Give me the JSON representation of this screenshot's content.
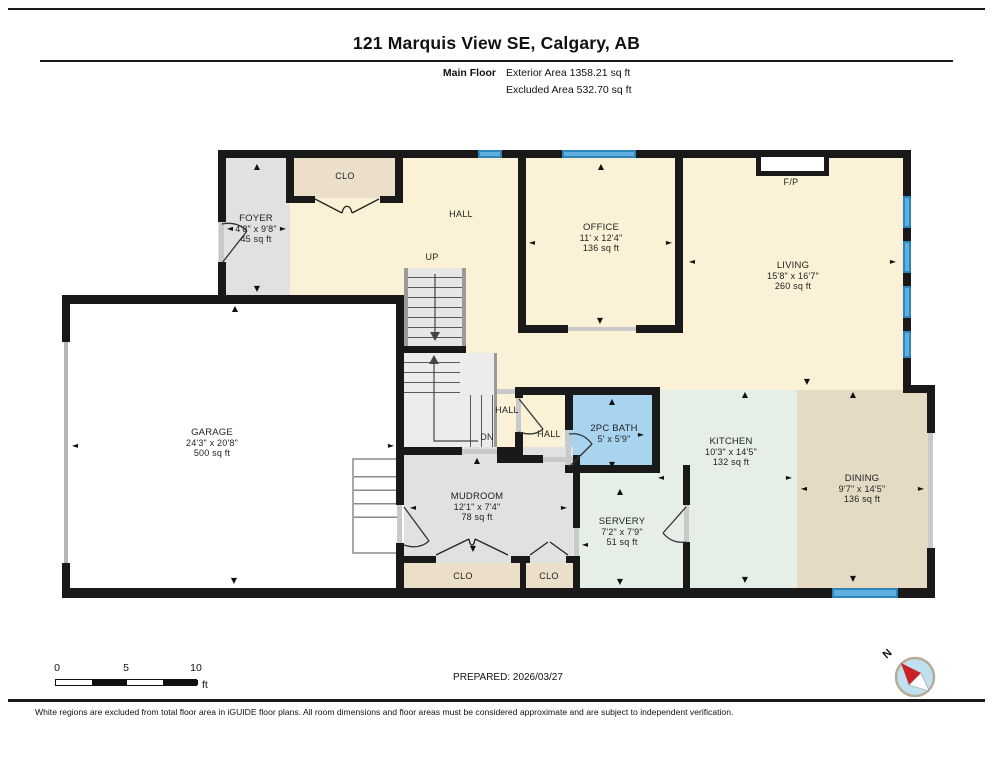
{
  "header": {
    "title": "121 Marquis View SE, Calgary, AB",
    "floor_label": "Main Floor",
    "exterior_area": "Exterior Area 1358.21 sq ft",
    "excluded_area": "Excluded Area 532.70 sq ft"
  },
  "rooms": {
    "foyer": {
      "name": "FOYER",
      "dims": "4'8\" x 9'8\"",
      "area": "45 sq ft"
    },
    "office": {
      "name": "OFFICE",
      "dims": "11' x 12'4\"",
      "area": "136 sq ft"
    },
    "living": {
      "name": "LIVING",
      "dims": "15'8\" x 16'7\"",
      "area": "260 sq ft"
    },
    "garage": {
      "name": "GARAGE",
      "dims": "24'3\" x 20'8\"",
      "area": "500 sq ft"
    },
    "mudroom": {
      "name": "MUDROOM",
      "dims": "12'1\" x 7'4\"",
      "area": "78 sq ft"
    },
    "bath": {
      "name": "2PC BATH",
      "dims": "5' x 5'9\""
    },
    "servery": {
      "name": "SERVERY",
      "dims": "7'2\" x 7'9\"",
      "area": "51 sq ft"
    },
    "kitchen": {
      "name": "KITCHEN",
      "dims": "10'3\" x 14'5\"",
      "area": "132 sq ft"
    },
    "dining": {
      "name": "DINING",
      "dims": "9'7\" x 14'5\"",
      "area": "136 sq ft"
    }
  },
  "labels": {
    "hall": "HALL",
    "up": "UP",
    "dn": "DN",
    "clo": "CLO",
    "fireplace": "F/P",
    "north": "N"
  },
  "footer": {
    "scale_ticks": [
      "0",
      "5",
      "10"
    ],
    "scale_unit": "ft",
    "prepared": "PREPARED: 2026/03/27",
    "disclaimer": "White regions are excluded from total floor area in iGUIDE floor plans. All room dimensions and floor areas must be considered approximate and are subject to independent verification."
  },
  "colors": {
    "cream": "#fbf1d7",
    "floor_gray": "#e1e1e1",
    "closet_tan": "#ecdfca",
    "bath_blue": "#a9d4ef",
    "mint": "#e6efe7",
    "dining_tan": "#e5dbc5",
    "wall": "#191919",
    "window": "#5fb0e0",
    "compass_red": "#cc2027",
    "compass_blue": "#bfe0ef"
  },
  "plan": {
    "arrows": [
      {
        "g": "▲",
        "x": 257,
        "y": 167
      },
      {
        "g": "▼",
        "x": 257,
        "y": 289
      },
      {
        "g": "◄",
        "x": 230,
        "y": 229
      },
      {
        "g": "►",
        "x": 283,
        "y": 229
      },
      {
        "g": "▲",
        "x": 601,
        "y": 167
      },
      {
        "g": "▼",
        "x": 600,
        "y": 321
      },
      {
        "g": "◄",
        "x": 532,
        "y": 243
      },
      {
        "g": "►",
        "x": 669,
        "y": 243
      },
      {
        "g": "◄",
        "x": 692,
        "y": 262
      },
      {
        "g": "►",
        "x": 893,
        "y": 262
      },
      {
        "g": "▼",
        "x": 807,
        "y": 382
      },
      {
        "g": "▲",
        "x": 235,
        "y": 309
      },
      {
        "g": "◄",
        "x": 75,
        "y": 446
      },
      {
        "g": "►",
        "x": 391,
        "y": 446
      },
      {
        "g": "▼",
        "x": 234,
        "y": 581
      },
      {
        "g": "▲",
        "x": 477,
        "y": 461
      },
      {
        "g": "▼",
        "x": 473,
        "y": 549
      },
      {
        "g": "◄",
        "x": 413,
        "y": 508
      },
      {
        "g": "►",
        "x": 564,
        "y": 508
      },
      {
        "g": "▲",
        "x": 612,
        "y": 402
      },
      {
        "g": "▼",
        "x": 612,
        "y": 465
      },
      {
        "g": "►",
        "x": 641,
        "y": 435
      },
      {
        "g": "▲",
        "x": 745,
        "y": 395
      },
      {
        "g": "▼",
        "x": 745,
        "y": 580
      },
      {
        "g": "◄",
        "x": 661,
        "y": 478
      },
      {
        "g": "►",
        "x": 789,
        "y": 478
      },
      {
        "g": "▲",
        "x": 853,
        "y": 395
      },
      {
        "g": "▼",
        "x": 853,
        "y": 579
      },
      {
        "g": "◄",
        "x": 804,
        "y": 489
      },
      {
        "g": "►",
        "x": 921,
        "y": 489
      },
      {
        "g": "▲",
        "x": 620,
        "y": 492
      },
      {
        "g": "▼",
        "x": 620,
        "y": 582
      },
      {
        "g": "◄",
        "x": 585,
        "y": 545
      }
    ]
  }
}
